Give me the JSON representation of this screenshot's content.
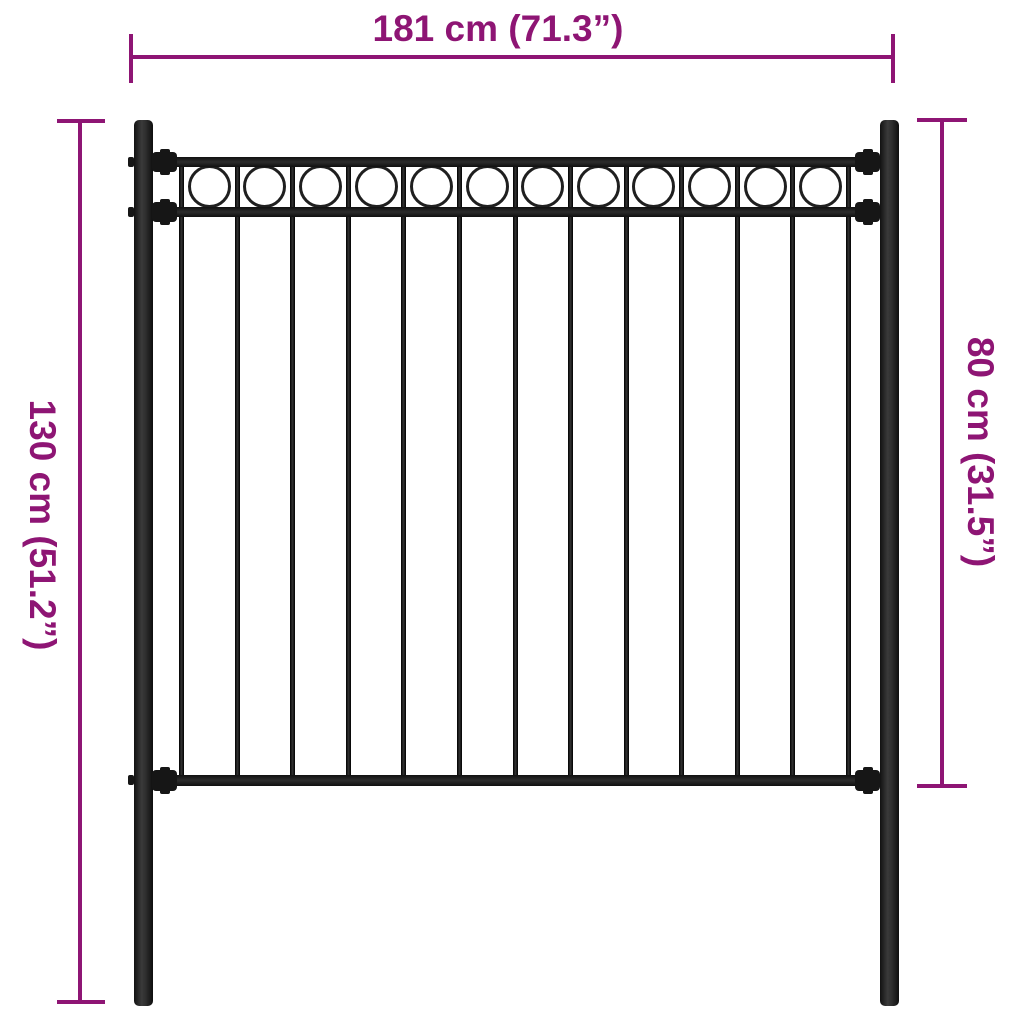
{
  "diagram": {
    "type": "product-dimension-diagram",
    "subject": "black steel fence panel with two posts, top ring ornaments and ground spikes",
    "colors": {
      "dimension_annotation": "#8E1574",
      "fence": "#1C1C1C",
      "background": "#FFFFFF"
    },
    "dimensions": {
      "width": {
        "label": "181 cm (71.3”)",
        "orientation": "horizontal"
      },
      "total_height": {
        "label": "130 cm (51.2”)",
        "orientation": "vertical-left"
      },
      "panel_height": {
        "label": "80 cm (31.5”)",
        "orientation": "vertical-right"
      }
    },
    "fence": {
      "post_count": 2,
      "rail_count": 3,
      "vertical_bar_count": 13,
      "ring_ornament_count": 12
    }
  }
}
